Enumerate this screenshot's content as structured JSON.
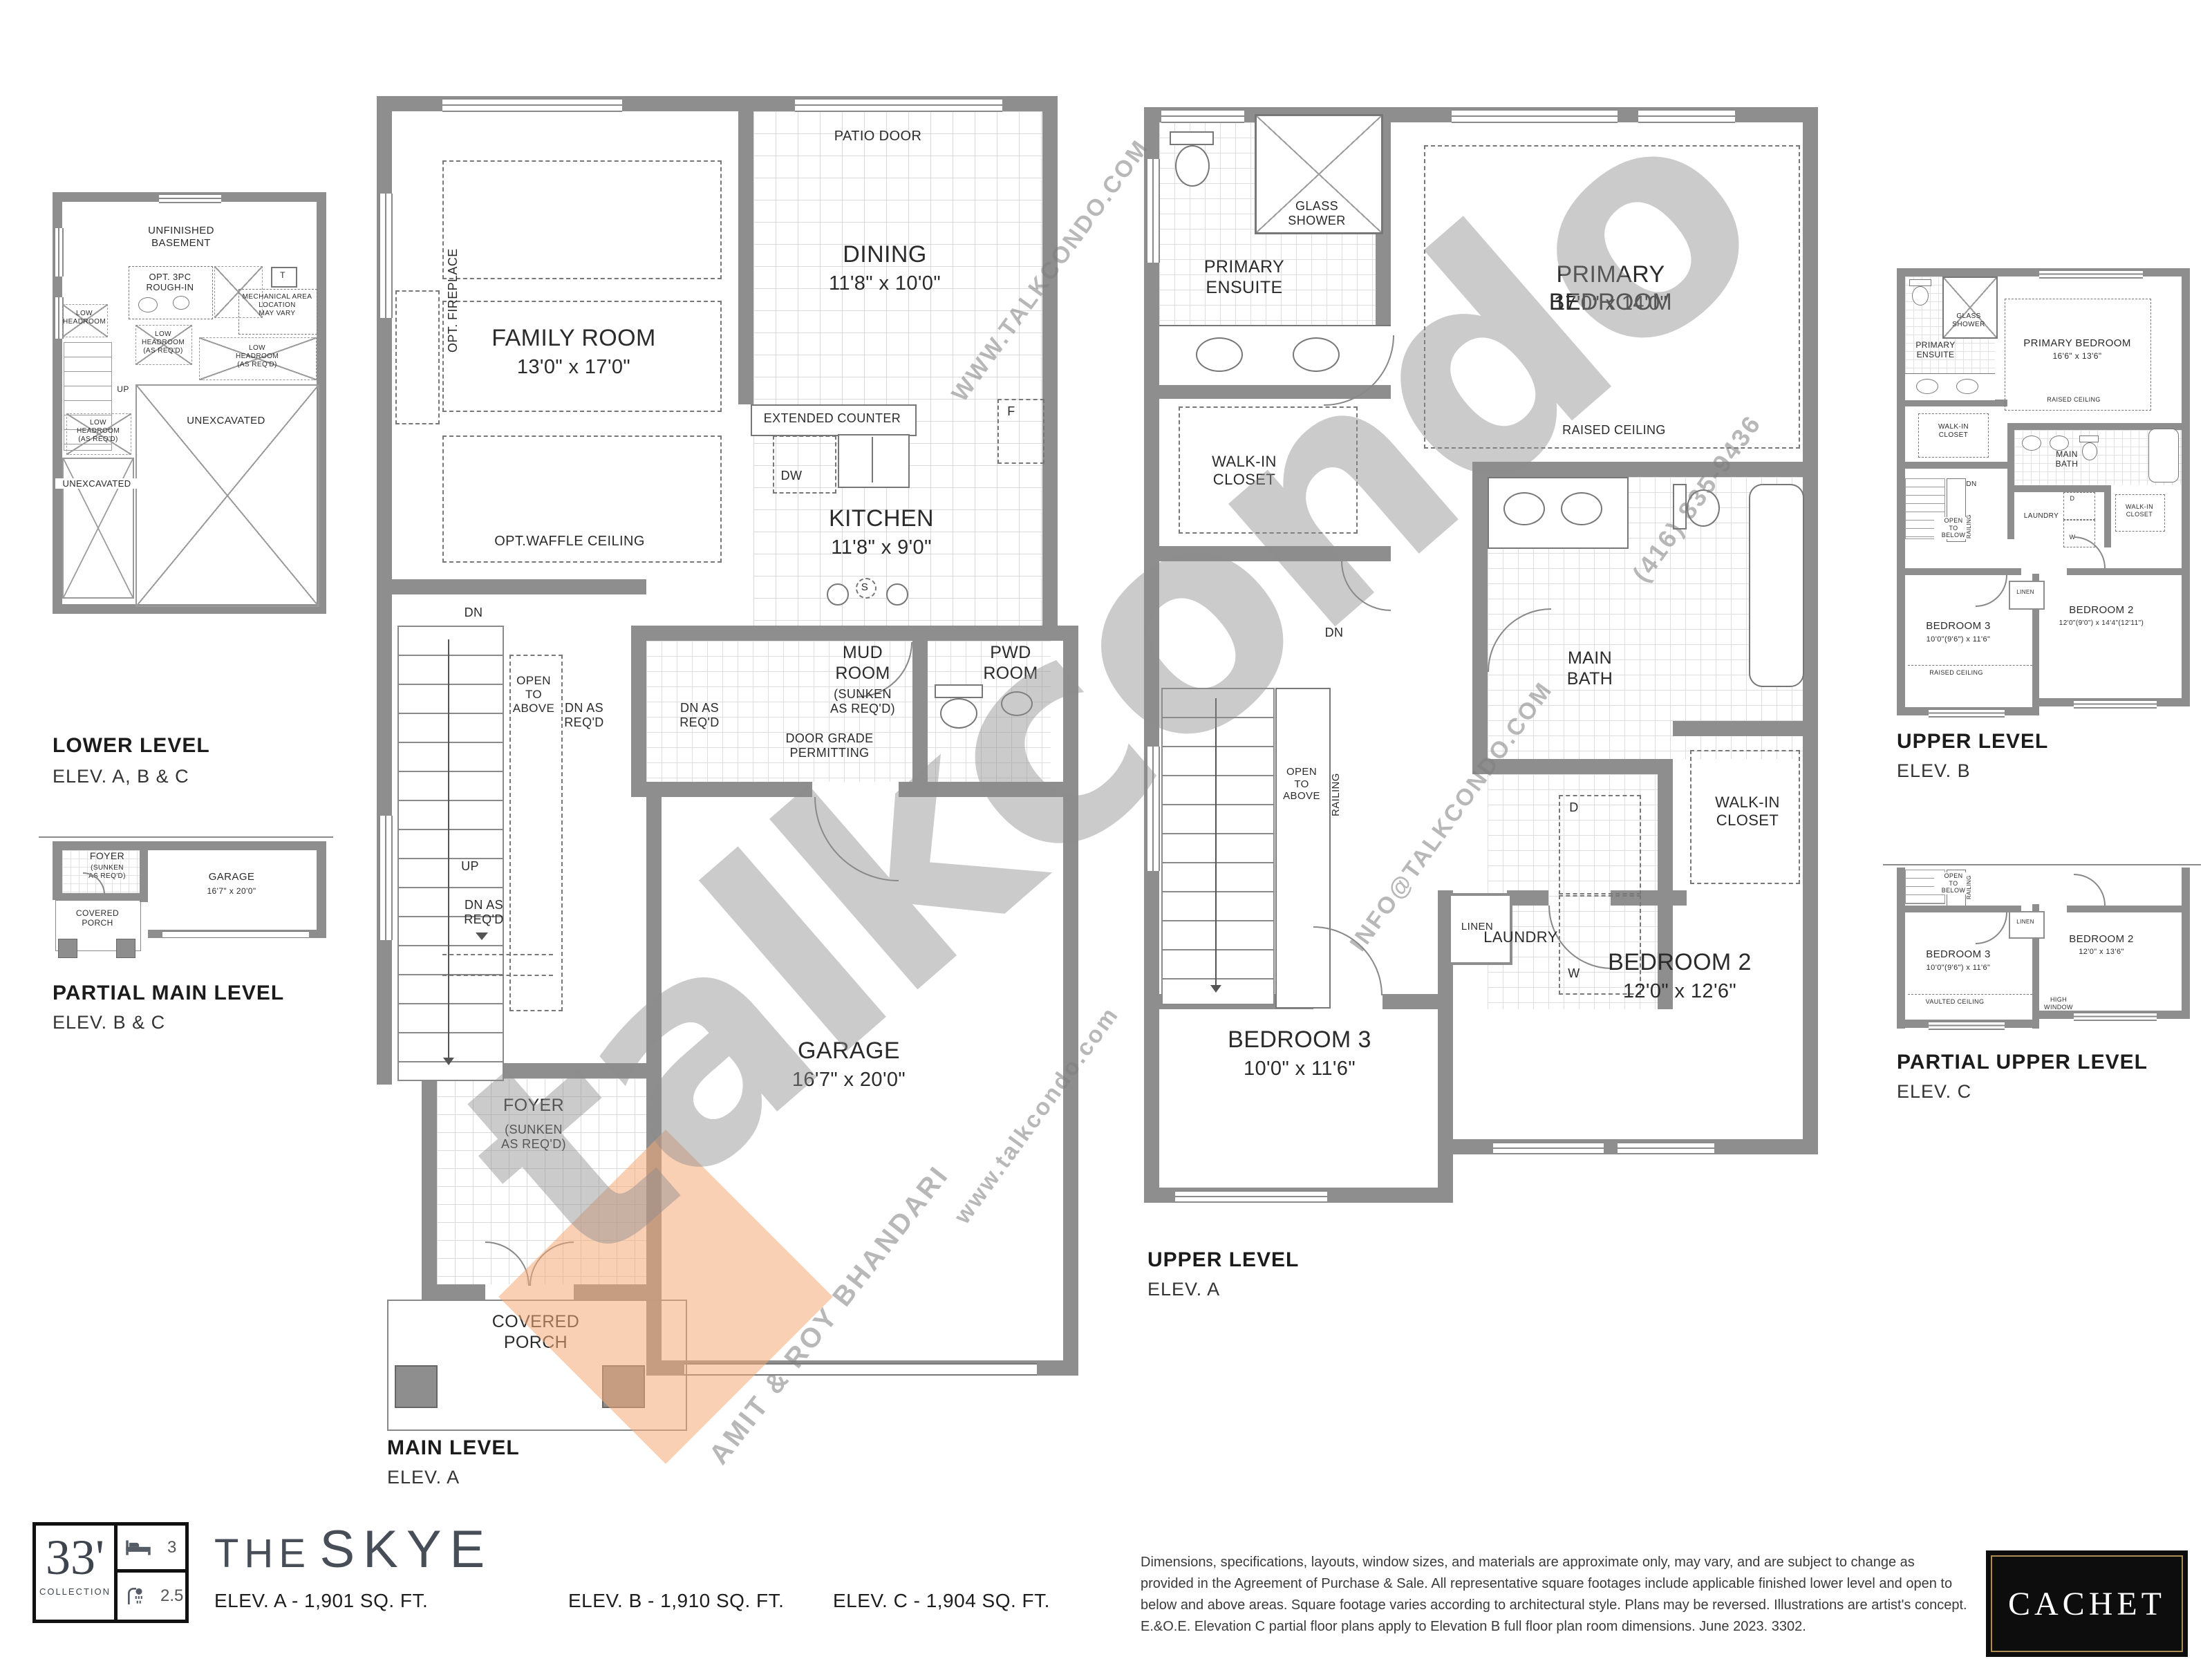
{
  "watermarks": {
    "brand": "talkcondo",
    "site_upper": "WWW.TALKCONDO.COM",
    "site_lower": "www.talkcondo.com",
    "email": "INFO@TALKCONDO.COM",
    "phone": "(416) 835-9436",
    "agents": "AMIT & ROY BHANDARI"
  },
  "plans": {
    "lower": {
      "title": "LOWER LEVEL",
      "elev": "ELEV. A, B & C",
      "basement": "UNFINISHED\nBASEMENT",
      "rough_in": "OPT. 3PC\nROUGH-IN",
      "tank": "T",
      "mech": "MECHANICAL AREA\nLOCATION\nMAY VARY",
      "low_headroom": "LOW\nHEADROOM",
      "low_headroom_req": "LOW\nHEADROOM\n(AS REQ'D)",
      "up": "UP",
      "unexcavated": "UNEXCAVATED"
    },
    "partial_main": {
      "title": "PARTIAL MAIN LEVEL",
      "elev": "ELEV. B & C",
      "foyer": "FOYER",
      "foyer_note": "(SUNKEN\nAS REQ'D)",
      "garage": "GARAGE",
      "garage_dims": "16'7\" x 20'0\"",
      "porch": "COVERED\nPORCH"
    },
    "main": {
      "title": "MAIN LEVEL",
      "elev": "ELEV. A",
      "patio_door": "PATIO DOOR",
      "dining": "DINING",
      "dining_dims": "11'8\" x 10'0\"",
      "family": "FAMILY ROOM",
      "family_dims": "13'0\" x 17'0\"",
      "opt_fireplace": "OPT. FIREPLACE",
      "opt_waffle": "OPT.WAFFLE CEILING",
      "extended_counter": "EXTENDED COUNTER",
      "dw": "DW",
      "fridge": "F",
      "stove": "S",
      "kitchen": "KITCHEN",
      "kitchen_dims": "11'8\" x 9'0\"",
      "dn": "DN",
      "dn_req": "DN AS\nREQ'D",
      "open_above": "OPEN\nTO\nABOVE",
      "up": "UP",
      "mud": "MUD\nROOM",
      "mud_note": "(SUNKEN\nAS REQ'D)",
      "pwd": "PWD\nROOM",
      "door_grade": "DOOR GRADE\nPERMITTING",
      "garage": "GARAGE",
      "garage_dims": "16'7\" x 20'0\"",
      "foyer": "FOYER",
      "foyer_note": "(SUNKEN\nAS REQ'D)",
      "porch": "COVERED\nPORCH"
    },
    "upper_a": {
      "title": "UPPER LEVEL",
      "elev": "ELEV. A",
      "ensuite": "PRIMARY\nENSUITE",
      "shower": "GLASS\nSHOWER",
      "primary": "PRIMARY BEDROOM",
      "primary_dims": "17'0\" x 14'0\"",
      "raised": "RAISED CEILING",
      "wic": "WALK-IN\nCLOSET",
      "bath": "MAIN\nBATH",
      "laundry": "LAUNDRY",
      "d": "D",
      "w": "W",
      "dn": "DN",
      "open_above": "OPEN\nTO\nABOVE",
      "railing": "RAILING",
      "linen": "LINEN",
      "bed2": "BEDROOM 2",
      "bed2_dims": "12'0\" x 12'6\"",
      "bed3": "BEDROOM 3",
      "bed3_dims": "10'0\" x 11'6\""
    },
    "upper_b": {
      "title": "UPPER LEVEL",
      "elev": "ELEV. B",
      "ensuite": "PRIMARY\nENSUITE",
      "shower": "GLASS\nSHOWER",
      "primary": "PRIMARY BEDROOM",
      "primary_dims": "16'6\" x 13'6\"",
      "raised": "RAISED CEILING",
      "wic": "WALK-IN\nCLOSET",
      "bath": "MAIN\nBATH",
      "laundry": "LAUNDRY",
      "d": "D",
      "w": "W",
      "dn": "DN",
      "open_below": "OPEN\nTO\nBELOW",
      "railing": "RAILING",
      "linen": "LINEN",
      "bed2": "BEDROOM 2",
      "bed2_dims": "12'0\"(9'0\") x 14'4\"(12'11\")",
      "bed3": "BEDROOM 3",
      "bed3_dims": "10'0\"(9'6\") x 11'6\""
    },
    "partial_c": {
      "title": "PARTIAL UPPER LEVEL",
      "elev": "ELEV. C",
      "open_below": "OPEN\nTO\nBELOW",
      "railing": "RAILING",
      "linen": "LINEN",
      "bed3": "BEDROOM 3",
      "bed3_dims": "10'0\"(9'6\") x 11'6\"",
      "vaulted": "VAULTED CEILING",
      "bed2": "BEDROOM 2",
      "bed2_dims": "12'0\" x 13'6\"",
      "high_window": "HIGH\nWINDOW"
    }
  },
  "footer": {
    "collection_size": "33'",
    "collection_word": "COLLECTION",
    "beds": "3",
    "baths": "2.5",
    "name_the": "THE",
    "name_skye": "SKYE",
    "elev_a": "ELEV. A - 1,901 SQ. FT.",
    "elev_b": "ELEV. B - 1,910 SQ. FT.",
    "elev_c": "ELEV. C - 1,904 SQ. FT.",
    "disclaimer": "Dimensions, specifications, layouts, window sizes, and materials are approximate only, may vary, and are subject to change as provided in the Agreement of Purchase & Sale. All representative square footages include applicable finished lower level and open to below and above areas. Square footage varies according to architectural style. Plans may be reversed. Illustrations are artist's concept. E.&O.E. Elevation C partial floor plans apply to Elevation B full floor plan room dimensions. June 2023. 3302.",
    "builder": "CACHET"
  }
}
